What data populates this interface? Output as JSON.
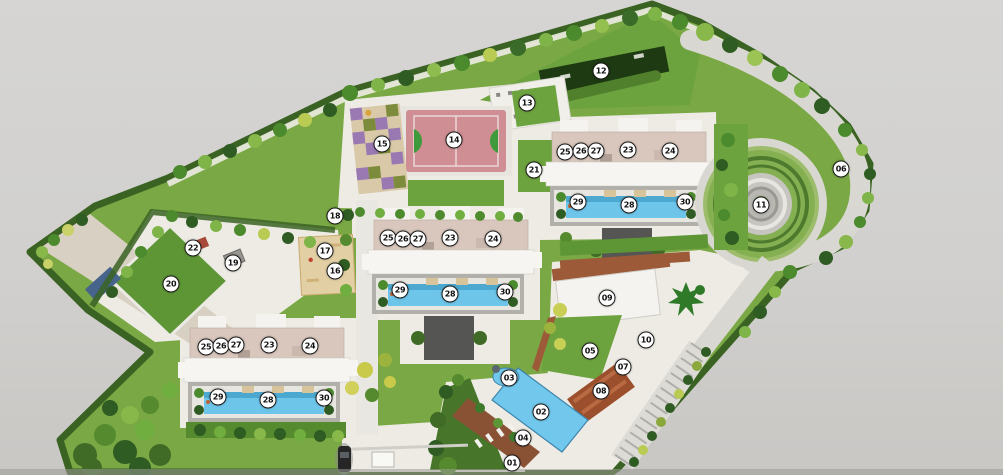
{
  "scene": {
    "type": "residential-township-master-plan",
    "background_color": "#d2d1cf"
  },
  "palette": {
    "lawn": "#79a844",
    "lawn_dark": "#5e9134",
    "hedge": "#3a6323",
    "tree_dark": "#2f5c22",
    "tree_mid": "#4c8a2e",
    "tree_light": "#7fb449",
    "tree_yellow": "#b9cb52",
    "pavement": "#edebe4",
    "road": "#d9d7d1",
    "pool_blue": "#6ec5ea",
    "court_pink": "#cf8e94",
    "court_key_green": "#3f9a3c",
    "building_white": "#f6f5f1",
    "building_top_pink": "#d9c7bd",
    "pool_deck_gray": "#b2b0ab",
    "terrace_brown": "#9c5a38",
    "tower_core_dark": "#555553",
    "sand": "#e0cda2",
    "play_purple": "#9a79b3",
    "panel_navy": "#46648c"
  },
  "marker_style": {
    "fill": "#ffffff",
    "border_color": "#1a1a1a",
    "text_color": "#111111",
    "diameter_px": 15
  },
  "markers": [
    {
      "label": "01",
      "x": 512,
      "y": 463
    },
    {
      "label": "02",
      "x": 541,
      "y": 412
    },
    {
      "label": "03",
      "x": 509,
      "y": 378
    },
    {
      "label": "04",
      "x": 523,
      "y": 438
    },
    {
      "label": "05",
      "x": 590,
      "y": 351
    },
    {
      "label": "06",
      "x": 841,
      "y": 169
    },
    {
      "label": "07",
      "x": 623,
      "y": 367
    },
    {
      "label": "08",
      "x": 601,
      "y": 391
    },
    {
      "label": "09",
      "x": 607,
      "y": 298
    },
    {
      "label": "10",
      "x": 646,
      "y": 340
    },
    {
      "label": "11",
      "x": 761,
      "y": 205
    },
    {
      "label": "12",
      "x": 601,
      "y": 71
    },
    {
      "label": "13",
      "x": 527,
      "y": 103
    },
    {
      "label": "14",
      "x": 454,
      "y": 140
    },
    {
      "label": "15",
      "x": 382,
      "y": 144
    },
    {
      "label": "16",
      "x": 335,
      "y": 271
    },
    {
      "label": "17",
      "x": 325,
      "y": 251
    },
    {
      "label": "18",
      "x": 335,
      "y": 216
    },
    {
      "label": "19",
      "x": 233,
      "y": 263
    },
    {
      "label": "20",
      "x": 171,
      "y": 284
    },
    {
      "label": "21",
      "x": 534,
      "y": 170
    },
    {
      "label": "22",
      "x": 193,
      "y": 248
    },
    {
      "label": "25",
      "x": 565,
      "y": 152
    },
    {
      "label": "26",
      "x": 581,
      "y": 151
    },
    {
      "label": "27",
      "x": 596,
      "y": 151
    },
    {
      "label": "23",
      "x": 628,
      "y": 150
    },
    {
      "label": "24",
      "x": 670,
      "y": 151
    },
    {
      "label": "29",
      "x": 578,
      "y": 202
    },
    {
      "label": "28",
      "x": 629,
      "y": 205
    },
    {
      "label": "30",
      "x": 685,
      "y": 202
    },
    {
      "label": "25",
      "x": 388,
      "y": 238
    },
    {
      "label": "26",
      "x": 403,
      "y": 239
    },
    {
      "label": "27",
      "x": 418,
      "y": 239
    },
    {
      "label": "23",
      "x": 450,
      "y": 238
    },
    {
      "label": "24",
      "x": 493,
      "y": 239
    },
    {
      "label": "29",
      "x": 400,
      "y": 290
    },
    {
      "label": "28",
      "x": 450,
      "y": 294
    },
    {
      "label": "30",
      "x": 505,
      "y": 292
    },
    {
      "label": "25",
      "x": 206,
      "y": 347
    },
    {
      "label": "26",
      "x": 221,
      "y": 346
    },
    {
      "label": "27",
      "x": 236,
      "y": 345
    },
    {
      "label": "23",
      "x": 269,
      "y": 345
    },
    {
      "label": "24",
      "x": 310,
      "y": 346
    },
    {
      "label": "29",
      "x": 218,
      "y": 397
    },
    {
      "label": "28",
      "x": 268,
      "y": 400
    },
    {
      "label": "30",
      "x": 324,
      "y": 398
    }
  ]
}
